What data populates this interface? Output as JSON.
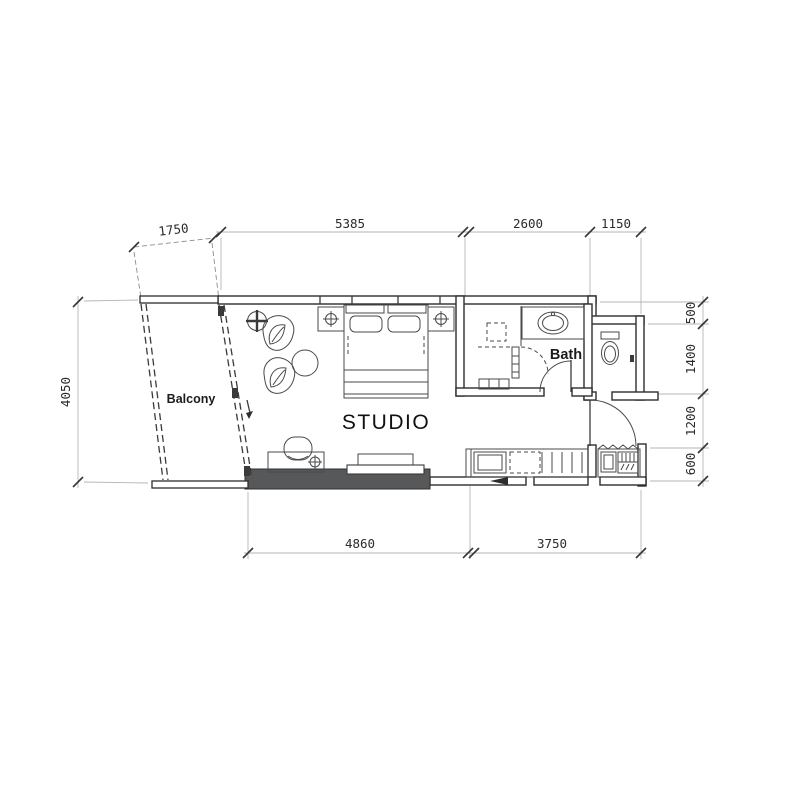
{
  "rooms": {
    "studio": "STUDIO",
    "balcony": "Balcony",
    "bath": "Bath"
  },
  "dimensions": {
    "top": [
      "1750",
      "5385",
      "2600",
      "1150"
    ],
    "left": [
      "4050"
    ],
    "right": [
      "500",
      "1400",
      "1200",
      "600"
    ],
    "bottom": [
      "4860",
      "3750"
    ]
  },
  "colors": {
    "wall_line": "#2d2d2d",
    "furniture_line": "#4a4a4a",
    "dimension_line": "#b5b5b5",
    "solid_wall_fill": "#57585a",
    "background": "#ffffff"
  }
}
